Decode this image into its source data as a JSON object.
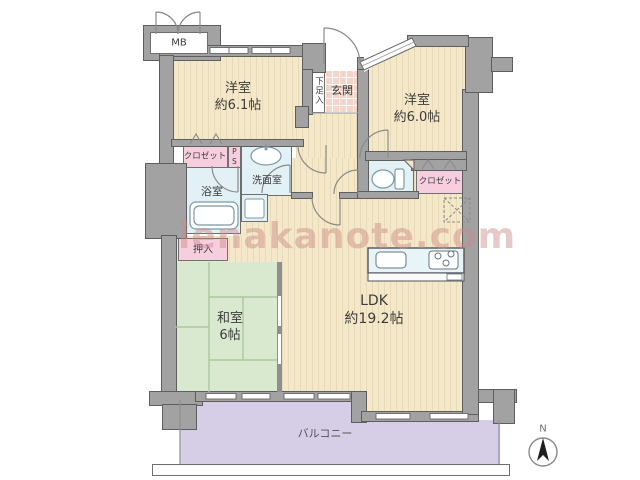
{
  "watermark": "ienakanote.com",
  "compass": {
    "label": "N"
  },
  "rooms": {
    "meter_box": {
      "label": "MB"
    },
    "bedroom1": {
      "name": "洋室",
      "size": "約6.1帖"
    },
    "bedroom2": {
      "name": "洋室",
      "size": "約6.0帖"
    },
    "entrance": {
      "name": "玄関"
    },
    "shoe_box": {
      "name": "下足入"
    },
    "closet_left": {
      "name": "クロゼット"
    },
    "pipe_space": {
      "name": "PS"
    },
    "washroom": {
      "name": "洗面室"
    },
    "bathroom": {
      "name": "浴室"
    },
    "oshiire": {
      "name": "押入"
    },
    "japanese_room": {
      "name": "和室",
      "size": "6帖"
    },
    "ldk": {
      "name": "LDK",
      "size": "約19.2帖"
    },
    "closet_right": {
      "name": "クロゼット"
    },
    "balcony": {
      "name": "バルコニー"
    }
  },
  "colors": {
    "wall_gray": "#a2a2a2",
    "room_beige": "#f4e8c8",
    "tatami_green": "#d9e9cf",
    "wet_blue": "#e2f1f5",
    "closet_pink": "#f7cedd",
    "entrance_pink": "#f3d4c6",
    "balcony_purple": "#d6cde6",
    "watermark_pink": "#cd8787"
  }
}
